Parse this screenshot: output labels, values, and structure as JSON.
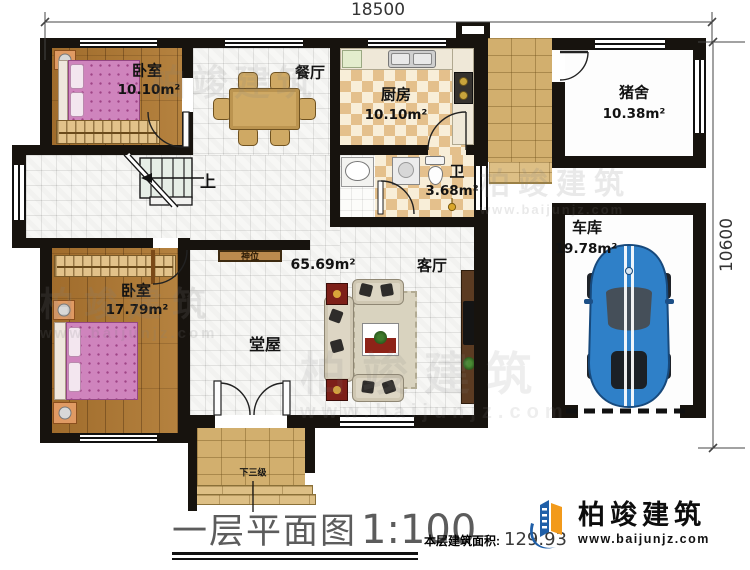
{
  "dimensions": {
    "width_mm": "18500",
    "height_mm": "10600"
  },
  "rooms": {
    "bedroom1": {
      "name": "卧室",
      "area": "10.10m²"
    },
    "dining": {
      "name": "餐厅"
    },
    "kitchen": {
      "name": "厨房",
      "area": "10.10m²"
    },
    "pigpen": {
      "name": "猪舍",
      "area": "10.38m²"
    },
    "bathroom": {
      "name": "卫",
      "area": "3.68m²"
    },
    "garage": {
      "name": "车库",
      "area": "19.78m²"
    },
    "bedroom2": {
      "name": "卧室",
      "area": "17.79m²"
    },
    "hall": {
      "name": "堂屋",
      "area": "65.69m²"
    },
    "living": {
      "name": "客厅"
    }
  },
  "annotations": {
    "stairs_up": "上",
    "steps_down": "下三级",
    "shrine": "神位"
  },
  "title": {
    "name": "一层平面图",
    "scale": "1:100"
  },
  "footer": {
    "area_label": "本层建筑面积:",
    "area_value": "129.93"
  },
  "brand": {
    "name": "柏竣建筑",
    "url": "www.baijunjz.com"
  },
  "colors": {
    "wall": "#17130e",
    "wood_floor": "#ab7835",
    "bed_pink": "#cf84bd",
    "tile_checker": "#e4c08c",
    "brick": "#d2af6e",
    "car_blue": "#2f80c8",
    "logo_blue": "#1f5fa8",
    "logo_orange": "#f29a1b"
  }
}
